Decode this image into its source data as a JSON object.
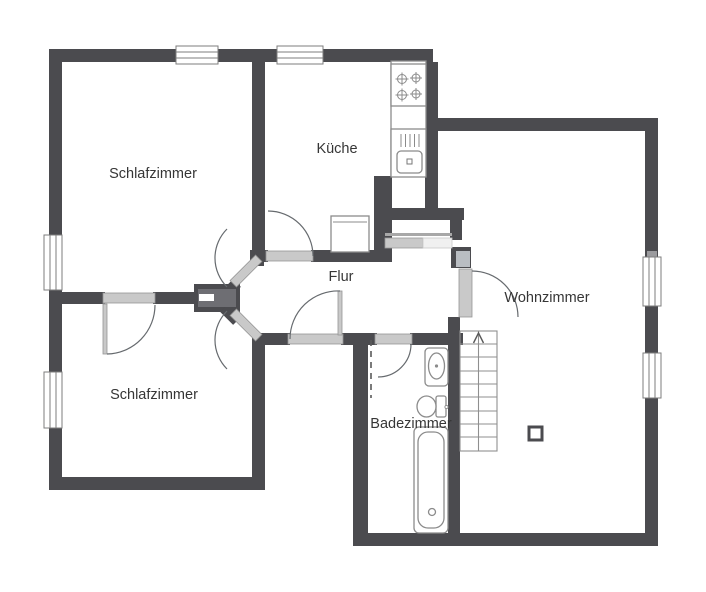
{
  "plan": {
    "rooms": {
      "schlafzimmer_top": {
        "label": "Schlafzimmer"
      },
      "kueche": {
        "label": "Küche"
      },
      "flur": {
        "label": "Flur"
      },
      "wohnzimmer": {
        "label": "Wohnzimmer"
      },
      "schlafzimmer_bottom": {
        "label": "Schlafzimmer"
      },
      "badezimmer": {
        "label": "Badezimmer"
      }
    },
    "colors": {
      "wall": "#4b4b4f",
      "door_leaf": "#c9c9c9",
      "fixture_stroke": "#8b8b8b",
      "text": "#363636",
      "background": "#ffffff"
    },
    "fixtures": [
      "stove-icon",
      "kitchen-sink-icon",
      "fridge-icon",
      "washbasin-icon",
      "toilet-icon",
      "bathtub-icon",
      "stairs-up-icon",
      "pillar-icon"
    ]
  }
}
